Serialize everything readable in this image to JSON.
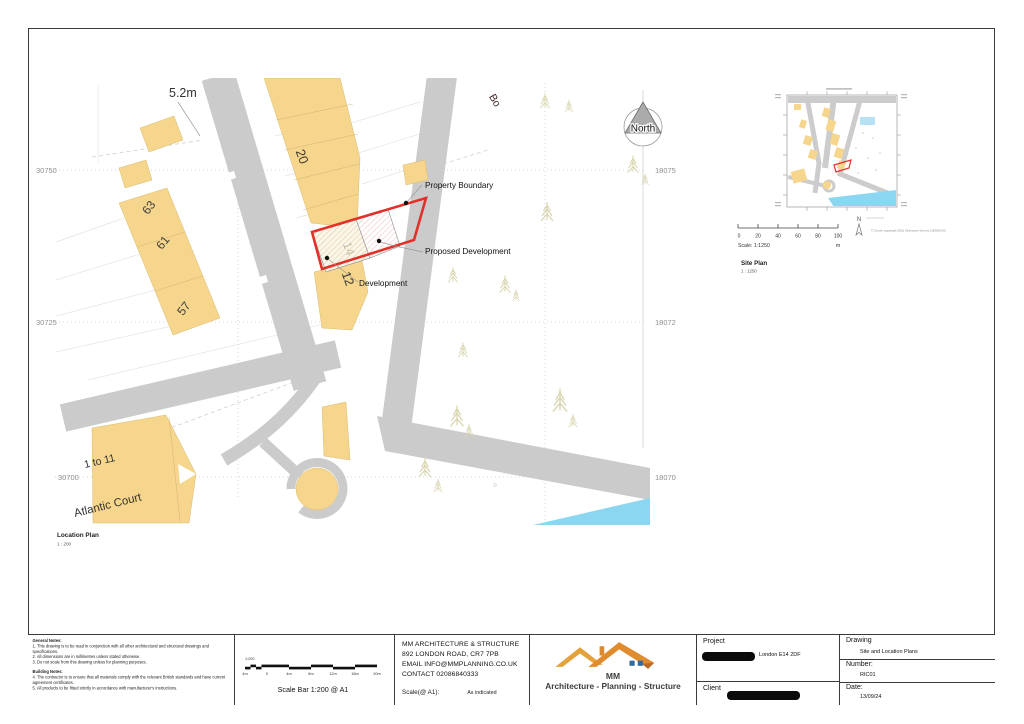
{
  "location_plan": {
    "caption": "Location Plan",
    "caption_scale": "1 : 200",
    "north_label": "North",
    "dimension_label": "5.2m",
    "street_label": "Bo",
    "annotations": {
      "property_boundary": "Property Boundary",
      "proposed_development": "Proposed Development",
      "development": "Development"
    },
    "buildings": {
      "b20": "20",
      "b63": "63",
      "b61": "61",
      "b57": "57",
      "b14": "14",
      "b12": "12",
      "atlantic_range": "1 to 11",
      "atlantic_name": "Atlantic Court"
    },
    "grid": {
      "left": [
        "30750",
        "30725",
        "30700"
      ],
      "right": [
        "18075",
        "18072",
        "18070"
      ]
    }
  },
  "site_plan": {
    "caption": "Site Plan",
    "caption_scale": "1 : 1250",
    "scale_text": "Scale: 1:1250",
    "unit": "m",
    "ticks": [
      "0",
      "20",
      "40",
      "60",
      "80",
      "100"
    ],
    "north_label": "N",
    "copyright": "© Crown copyright 2021 Ordnance Survey 100050143"
  },
  "scale_bar": {
    "caption": "Scale Bar 1:200 @ A1",
    "ratio_label": "1:200",
    "ticks": [
      "4m",
      "0",
      "4m",
      "8m",
      "12m",
      "16m",
      "20m"
    ]
  },
  "notes": {
    "general_title": "General Notes:",
    "general": [
      "1. This drawing is to be read in conjunction with all other architectural and structural drawings and specifications.",
      "2. All dimensions are in millimetres unless stated otherwise.",
      "3. Do not scale from this drawing unless for planning purposes."
    ],
    "building_title": "Building Notes:",
    "building": [
      "4. The contractor is to ensure that all materials comply with the relevant British standards and have current agreement certificates.",
      "5. All products to be fitted strictly in accordance with manufacturer's instructions."
    ]
  },
  "firm": {
    "name": "MM ARCHITECTURE & STRUCTURE",
    "address": "892 LONDON ROAD, CR7 7PB",
    "email": "EMAIL INFO@MMPLANNING.CO.UK",
    "contact": "CONTACT 02086840333",
    "scale_label": "Scale(@ A1):",
    "scale_value": "As indicated"
  },
  "logo": {
    "initials": "MM",
    "tagline": "Architecture - Planning - Structure"
  },
  "titleblock": {
    "project_label": "Project",
    "project_value": "London E14 2DF",
    "client_label": "Client",
    "drawing_label": "Drawing",
    "drawing_value": "Site and Location Plans",
    "number_label": "Number:",
    "number_value": "RIC01",
    "date_label": "Date:",
    "date_value": "13/09/24"
  },
  "colors": {
    "building_fill": "#F6D58C",
    "road_fill": "#CBCBCB",
    "boundary_red": "#E2312A",
    "water": "#8BD7F2",
    "tree": "#D8D4AE",
    "logo_left_roof": "#E3A23C",
    "logo_right_roof": "#E08B2E",
    "logo_window_blue": "#2F6B9E"
  }
}
